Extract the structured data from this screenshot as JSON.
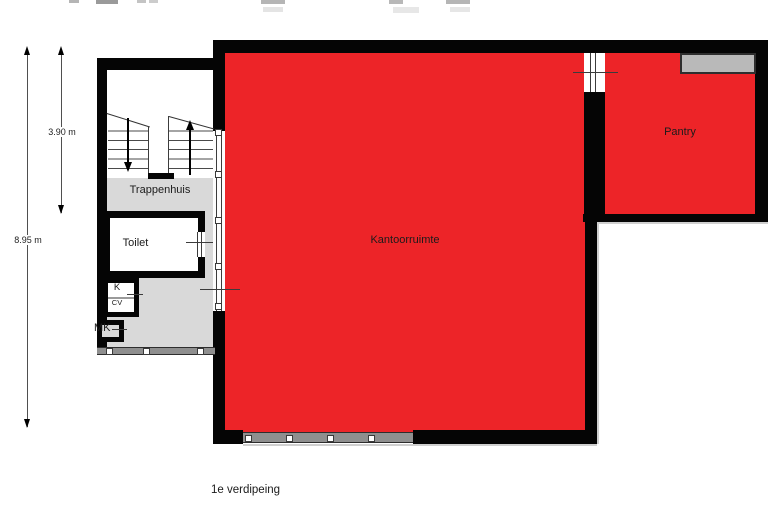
{
  "caption": "1e verdipeing",
  "rooms": {
    "stairwell": {
      "label": "Trappenhuis"
    },
    "toilet": {
      "label": "Toilet"
    },
    "closet_k": {
      "label": "K"
    },
    "closet_cv": {
      "label": "CV"
    },
    "closet_mk": {
      "label": "MK"
    },
    "office": {
      "label": "Kantoorruimte"
    },
    "pantry": {
      "label": "Pantry"
    }
  },
  "dimensions": {
    "total_height": "8.95 m",
    "stair_section": "3.90 m"
  },
  "palette": {
    "room_red": "#ed2428",
    "hall_gray": "#d9d9d9",
    "counter_gray": "#b9b9b9",
    "wall_black": "#050505",
    "line_dark": "#3c3c3c",
    "band_gray": "#8f8f8f"
  }
}
